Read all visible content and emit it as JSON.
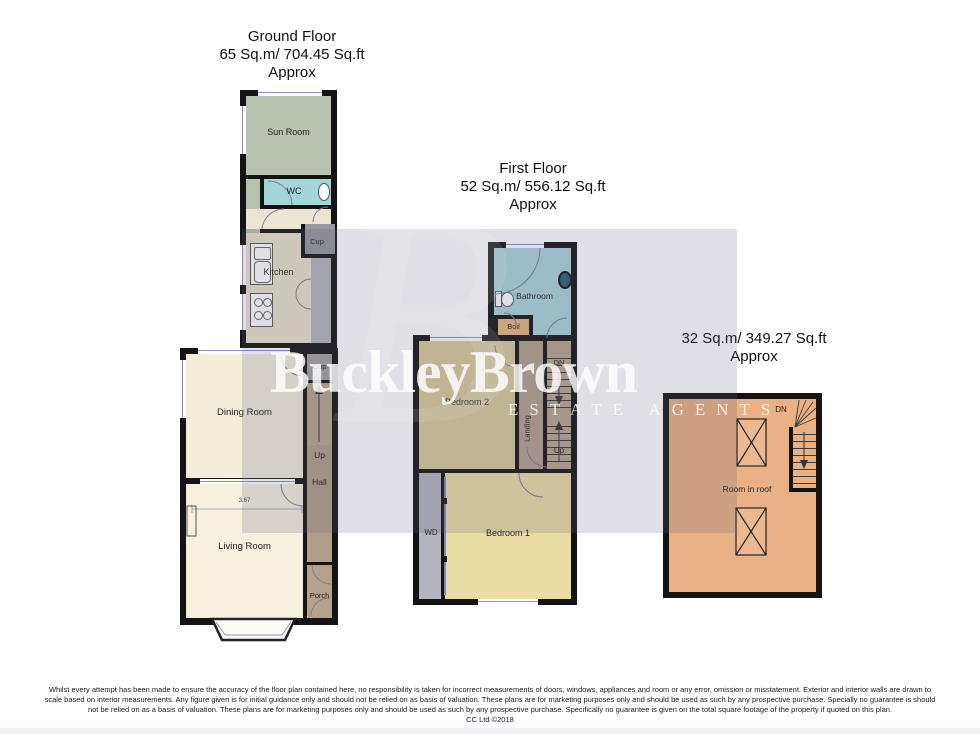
{
  "ground": {
    "title": "Ground Floor",
    "area": "65 Sq.m/ 704.45 Sq.ft",
    "approx": "Approx",
    "rooms": {
      "sun_room": "Sun Room",
      "wc": "WC",
      "cup_upper": "Cup",
      "kitchen": "Kitchen",
      "cup_stairs": "Cup",
      "dining_room": "Dining Room",
      "up": "Up",
      "hall": "Hall",
      "living_room": "Living Room",
      "dimension": "3.67",
      "porch": "Porch"
    }
  },
  "first": {
    "title": "First Floor",
    "area": "52 Sq.m/ 556.12 Sq.ft",
    "approx": "Approx",
    "rooms": {
      "bathroom": "Bathroom",
      "boil": "Boil",
      "bedroom2": "Bedroom 2",
      "landing": "Landing",
      "dn": "DN",
      "up": "Up",
      "wd": "WD",
      "bedroom1": "Bedroom 1"
    }
  },
  "roof": {
    "area": "32 Sq.m/ 349.27 Sq.ft",
    "approx": "Approx",
    "rooms": {
      "room_in_roof": "Room in roof",
      "dn": "DN"
    }
  },
  "watermark": {
    "brand": "BuckleyBrown",
    "tagline": "ESTATE AGENTS",
    "monogram": "B"
  },
  "footer": {
    "line1": "Whilst every attempt has been made to ensure the accuracy of the floor plan contained here, no responsibility is taken for incorrect measurements of doors, windows, appliances and room or any error, omission or misstatement. Exterior and interior walls are drawn to",
    "line2": "scale based on interior measurements. Any figure given is for initial guidance only and should not be relied on as basis of valuation. These plans are for marketing purposes only and should be used as such by any prospective purchase. Specially no guarantee is should",
    "line3": "not be relied on as a basis of valuation. These plans are for marketing purposes only and should be used as such by any prospective purchase. Specifically no guarantee is given on the total square footage of the property if quoted on this plan.",
    "credit": "CC Ltd ©2018"
  },
  "colors": {
    "wall": "#141414",
    "sun_room": "#b9c1b1",
    "wc": "#a3d6d6",
    "lobby": "#ece5d2",
    "kitchen": "#e9e1cc",
    "cupboard_gray": "#97979d",
    "hall_brown": "#b29f8a",
    "stairs_brown": "#b7a58f",
    "dining": "#f3edda",
    "living": "#f6f1df",
    "bathroom": "#a9d5da",
    "boiler": "#e7b77f",
    "bedroom2": "#d8cb9b",
    "bedroom1": "#eadda4",
    "wardrobe": "#b4b4bc",
    "roof_room": "#e9b184",
    "watermark_tint": "#60607d",
    "window_glass": "#8a93c4"
  }
}
